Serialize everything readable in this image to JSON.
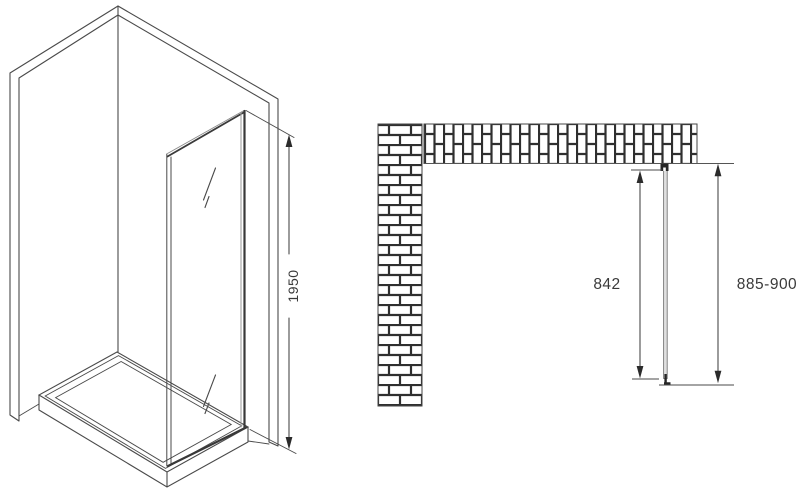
{
  "drawing": {
    "isometric_view": {
      "name": "corner-shower-side-panel-isometric-view",
      "height_label": "1950"
    },
    "plan_view": {
      "name": "top-plan-view-with-brick-walls",
      "panel_length_label": "842",
      "install_width_label": "885-900"
    },
    "colors": {
      "background": "#ffffff",
      "line": "#4a4a4a",
      "dark_line": "#2f2f2f",
      "arrow": "#2b2b2b",
      "text": "#3a3a3a",
      "glass_plan_fill": "#e0e0e0"
    }
  }
}
